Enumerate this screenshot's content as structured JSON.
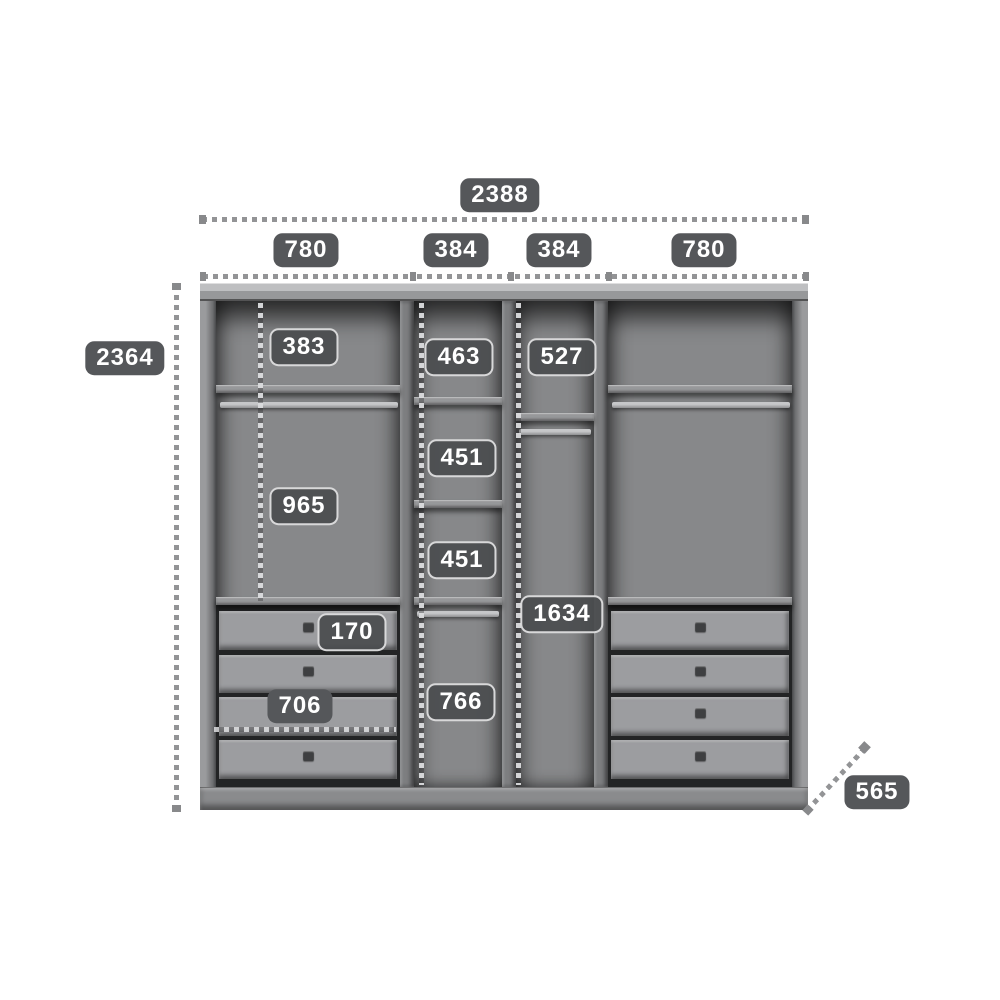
{
  "diagram": {
    "subject": "wardrobe-interior-dimension-diagram",
    "unit": "mm"
  },
  "colors": {
    "background": "#ffffff",
    "label_bg": "#55575a",
    "label_text": "#ffffff",
    "dotted_line": "#939496",
    "wood_base": "#87888a",
    "drawer_front": "#9c9da0"
  },
  "dims": {
    "total_width": "2388",
    "outer_section_width_left": "780",
    "inner_section_width_left": "384",
    "inner_section_width_right": "384",
    "outer_section_width_right": "780",
    "total_height": "2364",
    "depth": "565",
    "left_upper_height": "383",
    "left_lower_height": "965",
    "mid1_shelf1_height": "463",
    "mid1_shelf2_height": "451",
    "mid1_shelf3_height": "451",
    "mid1_lower_height": "766",
    "mid2_upper_height": "527",
    "mid2_lower_height": "1634",
    "top_drawer_height": "170",
    "drawer_unit_width": "706"
  }
}
